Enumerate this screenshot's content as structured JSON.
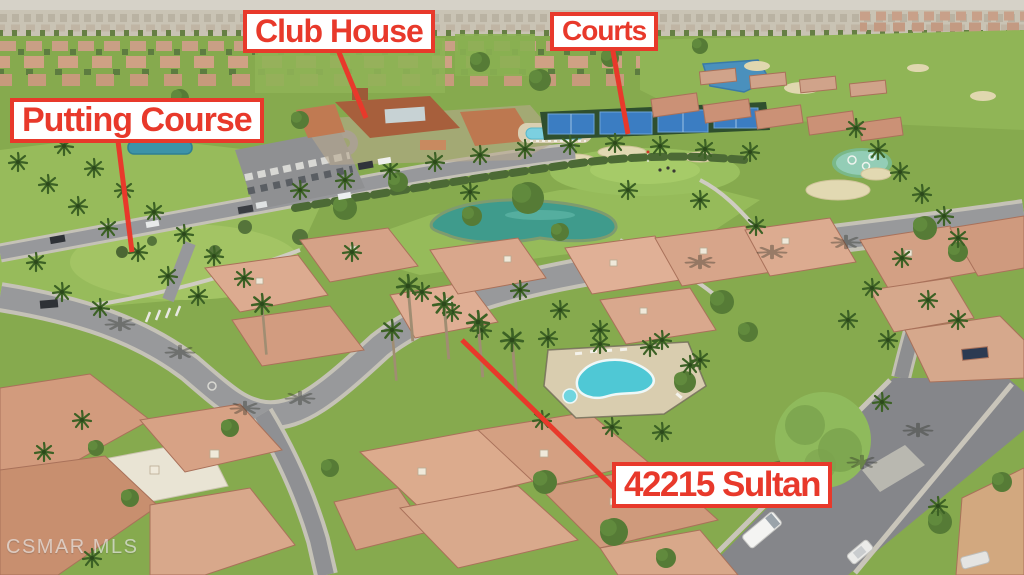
{
  "scene_description": "Aerial drone photograph of a desert golf-course residential community with red real-estate annotation callouts",
  "labels": {
    "putting_course": "Putting Course",
    "club_house": "Club House",
    "courts": "Courts",
    "property_address": "42215 Sultan"
  },
  "watermark": "CSMAR MLS",
  "scene_features": [
    "distant city skyline",
    "rows of tile-roof houses",
    "golf fairways with sand bunkers",
    "ponds",
    "club house buildings with parking lot",
    "lap pool",
    "tennis courts",
    "putting green",
    "community pool and spa",
    "curving residential streets",
    "palm trees",
    "white van",
    "parked cars"
  ],
  "style": {
    "annotation_red": "#e8392b",
    "annotation_bg": "#ffffff",
    "grass_green": "#86aa4e",
    "fairway_green": "#97bb5b",
    "road_gray": "#98999b",
    "roof_terracotta": "#cd9075",
    "pool_turquoise": "#4fc8d5",
    "pond_teal": "#3f9b8c",
    "tennis_blue": "#3b7dc2",
    "sand_tan": "#e2d9b2",
    "palm_green": "#3c6125",
    "watermark_gray": "#e6e6e6"
  }
}
